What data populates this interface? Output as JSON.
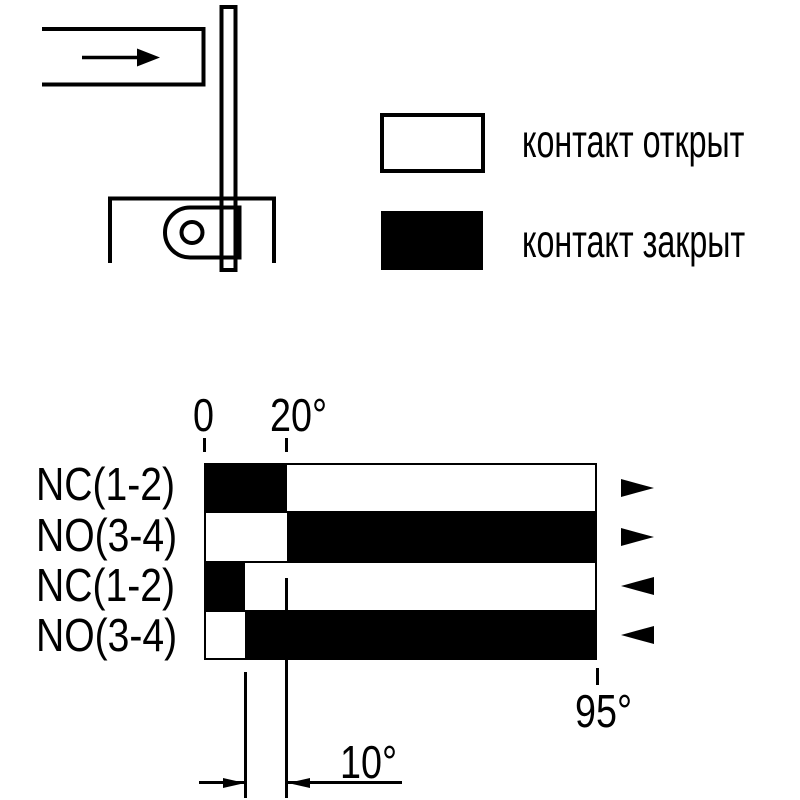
{
  "colors": {
    "ink": "#000000",
    "paper": "#ffffff"
  },
  "legend": {
    "open_label": "контакт открыт",
    "closed_label": "контакт закрыт"
  },
  "mechanism": {
    "parts": [
      "actuator-dog",
      "motion-arrow",
      "lever-rod",
      "switch-housing",
      "roller-lever",
      "pivot-hole"
    ]
  },
  "chart_data": {
    "type": "contact-state-bands",
    "unit": "degrees",
    "axis_range_deg": [
      0,
      95
    ],
    "states": {
      "open": "#ffffff",
      "closed": "#000000"
    },
    "rows": [
      {
        "label": "NC(1-2)",
        "direction": "forward",
        "segments": [
          {
            "from": 0,
            "to": 20,
            "state": "closed"
          },
          {
            "from": 20,
            "to": 95,
            "state": "open"
          }
        ]
      },
      {
        "label": "NO(3-4)",
        "direction": "forward",
        "segments": [
          {
            "from": 0,
            "to": 20,
            "state": "open"
          },
          {
            "from": 20,
            "to": 95,
            "state": "closed"
          }
        ]
      },
      {
        "label": "NC(1-2)",
        "direction": "return",
        "segments": [
          {
            "from": 0,
            "to": 10,
            "state": "closed"
          },
          {
            "from": 10,
            "to": 95,
            "state": "open"
          }
        ]
      },
      {
        "label": "NO(3-4)",
        "direction": "return",
        "segments": [
          {
            "from": 0,
            "to": 10,
            "state": "open"
          },
          {
            "from": 10,
            "to": 95,
            "state": "closed"
          }
        ]
      }
    ],
    "ticks_top": [
      {
        "deg": 0,
        "label": "0"
      },
      {
        "deg": 20,
        "label": "20°"
      }
    ],
    "tick_bottom": {
      "deg": 95,
      "label": "95°"
    },
    "differential": {
      "from_deg": 10,
      "to_deg": 20,
      "label": "10°"
    }
  }
}
